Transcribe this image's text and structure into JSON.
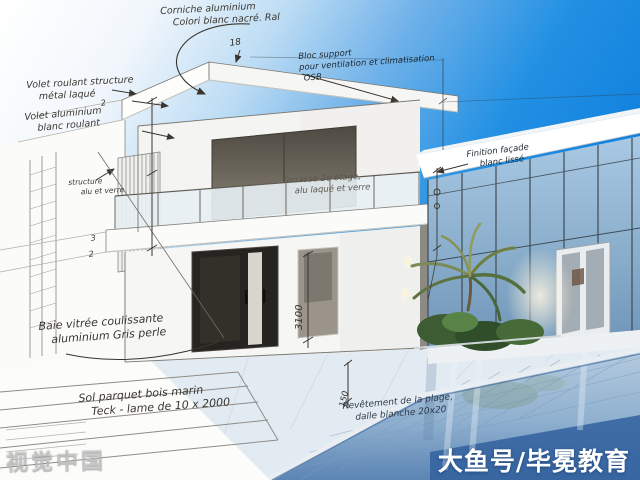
{
  "annotations": {
    "cornice": {
      "line1": "Corniche aluminium",
      "line2": "Colori blanc nacré. Ral"
    },
    "bloc_support": {
      "line1": "Bloc support",
      "line2": "pour ventilation et climatisation",
      "line3": "OSB"
    },
    "facade": {
      "line1": "Finition façade",
      "line2": "blanc lissé"
    },
    "terrasse": {
      "line1": "Terrasse 2e étage,",
      "line2": "alu laqué et verre"
    },
    "volet_structure": {
      "line1": "Volet roulant structure",
      "line2": "métal laqué"
    },
    "volet_alu": {
      "line1": "Volet aluminium",
      "line2": "blanc roulant"
    },
    "brise": {
      "line1": "structure",
      "line2": "alu et verre"
    },
    "baie": {
      "line1": "Baie vitrée coulissante",
      "line2": "aluminium Gris perle"
    },
    "sol": {
      "line1": "Sol parquet bois marin",
      "line2": "Teck - lame de 10 x 2000"
    },
    "revetement": {
      "line1": "Revêtement de la plage,",
      "line2": "dalle blanche 20x20"
    }
  },
  "dimensions": {
    "roof_offset": "18",
    "floor_height": "3100",
    "pool_coping": "150",
    "tick_a": "2",
    "tick_b": "3",
    "tick_c": "2"
  },
  "watermarks": {
    "bottom_left": "视觉中国",
    "bottom_right": "大鱼号/毕冕教育"
  },
  "colors": {
    "sky_blue": "#1182e0",
    "pool_blue": "#35629f",
    "ink": "#3a362f"
  }
}
